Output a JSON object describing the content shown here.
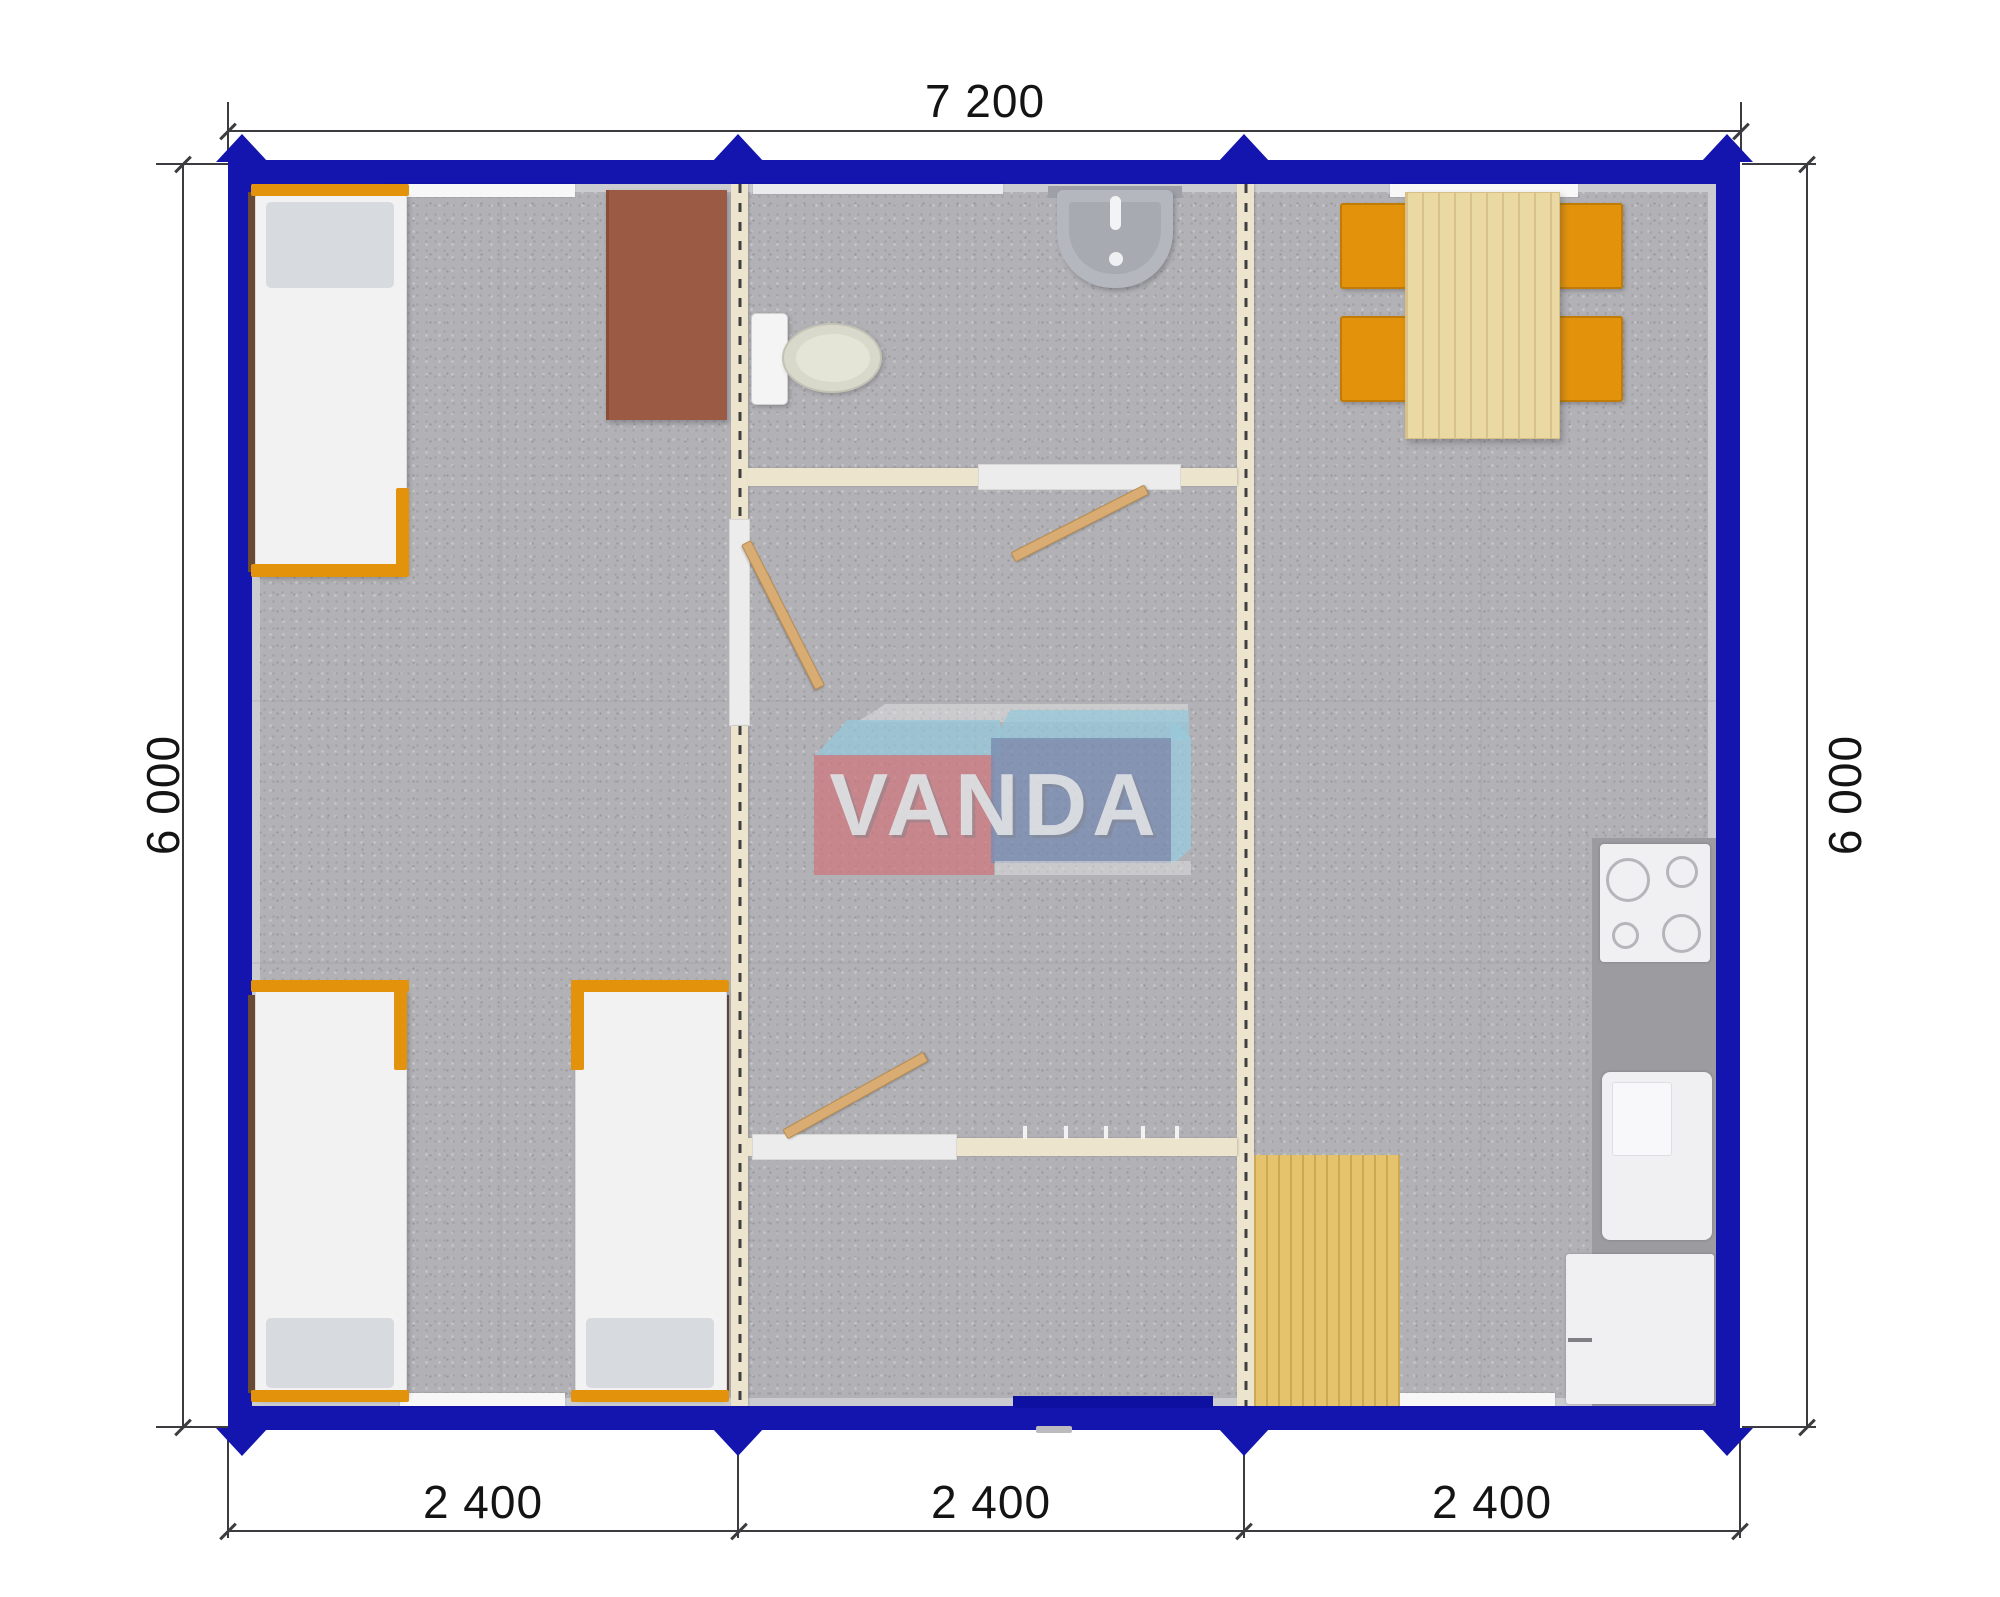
{
  "dimensions": {
    "top": "7 200",
    "left": "6 000",
    "right": "6 000",
    "bottom": [
      "2 400",
      "2 400",
      "2 400"
    ]
  },
  "logo": {
    "text": "VANDA"
  },
  "colors": {
    "wall_blue": "#1414ae",
    "partition_cream": "#ece4cd",
    "carpet_gray": "#b2b2b6",
    "furniture_orange": "#e2930b",
    "table_wood": "#ead9a2",
    "mat_wood": "#e5c36c",
    "door_wood": "#d8ac72",
    "desk_brown": "#9a5a43",
    "counter_gray": "#9c9ca0",
    "fixture_white": "#f2f2f4",
    "logo_red": "#cf757d",
    "logo_blue": "#7689b0",
    "logo_light_blue": "#94cadf",
    "dimension_line": "#3c3c40"
  }
}
